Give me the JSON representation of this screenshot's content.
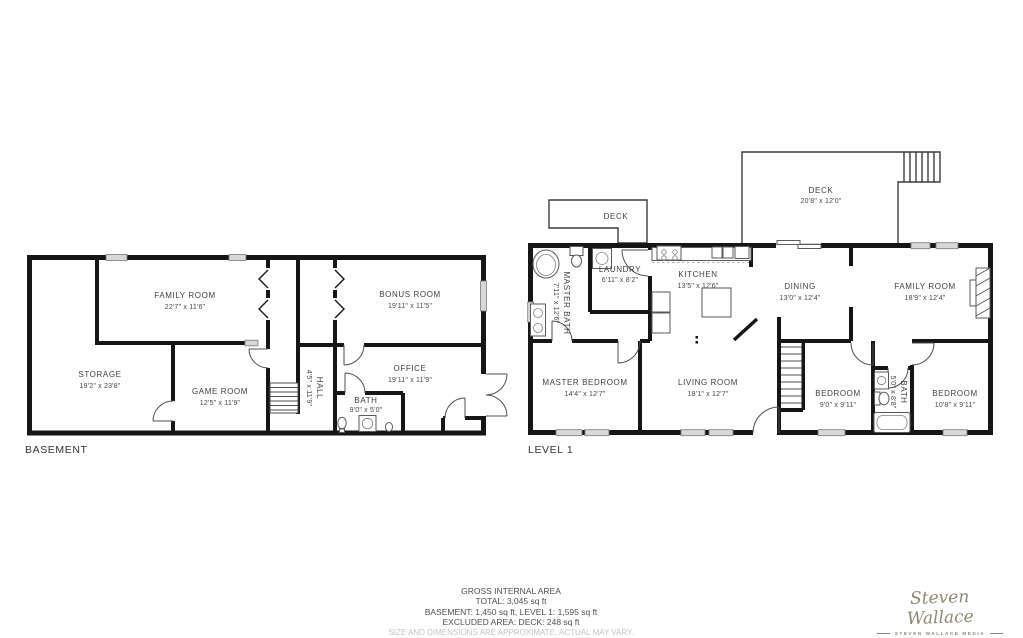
{
  "floors": {
    "basement": {
      "label": "BASEMENT",
      "rooms": {
        "family_room": {
          "name": "FAMILY ROOM",
          "dims": "22'7\" x 11'6\""
        },
        "storage": {
          "name": "STORAGE",
          "dims": "19'2\" x 23'8\""
        },
        "game_room": {
          "name": "GAME ROOM",
          "dims": "12'5\" x 11'9\""
        },
        "bonus_room": {
          "name": "BONUS ROOM",
          "dims": "19'11\" x 11'5\""
        },
        "office": {
          "name": "OFFICE",
          "dims": "19'11\" x 11'9\""
        },
        "bath": {
          "name": "BATH",
          "dims": "9'0\" x 5'0\""
        },
        "hall": {
          "name": "HALL",
          "dims": "4'5\" x 11'9\""
        }
      }
    },
    "level1": {
      "label": "LEVEL 1",
      "rooms": {
        "deck_small": {
          "name": "DECK",
          "dims": ""
        },
        "deck": {
          "name": "DECK",
          "dims": "20'8\" x 12'0\""
        },
        "master_bath": {
          "name": "MASTER BATH",
          "dims": "7'11\" x 12'6\""
        },
        "laundry": {
          "name": "LAUNDRY",
          "dims": "6'11\" x 8'2\""
        },
        "kitchen": {
          "name": "KITCHEN",
          "dims": "13'5\" x 12'6\""
        },
        "dining": {
          "name": "DINING",
          "dims": "13'0\" x 12'4\""
        },
        "family_room": {
          "name": "FAMILY ROOM",
          "dims": "18'9\" x 12'4\""
        },
        "master_bedroom": {
          "name": "MASTER BEDROOM",
          "dims": "14'4\" x 12'7\""
        },
        "living_room": {
          "name": "LIVING ROOM",
          "dims": "18'1\" x 12'7\""
        },
        "bedroom1": {
          "name": "BEDROOM",
          "dims": "9'0\" x 9'11\""
        },
        "bath": {
          "name": "BATH",
          "dims": "5'0\" x 8'8\""
        },
        "bedroom2": {
          "name": "BEDROOM",
          "dims": "10'8\" x 9'11\""
        }
      }
    }
  },
  "summary": {
    "title": "GROSS INTERNAL AREA",
    "total": "TOTAL: 3,045 sq ft",
    "levels": "BASEMENT: 1,450 sq ft, LEVEL 1: 1,595 sq ft",
    "excluded": "EXCLUDED AREA: DECK: 248 sq ft",
    "disclaimer": "SIZE AND DIMENSIONS ARE APPROXIMATE, ACTUAL MAY VARY."
  },
  "branding": {
    "script": "Steven Wallace",
    "sub": "STEVEN WALLACE MEDIA"
  },
  "colors": {
    "wall": "#161616",
    "label_text": "#414141",
    "logo": "#8d8773",
    "window": "#d8d8d8",
    "disclaimer": "#c4c4c4",
    "background": "#ffffff"
  }
}
